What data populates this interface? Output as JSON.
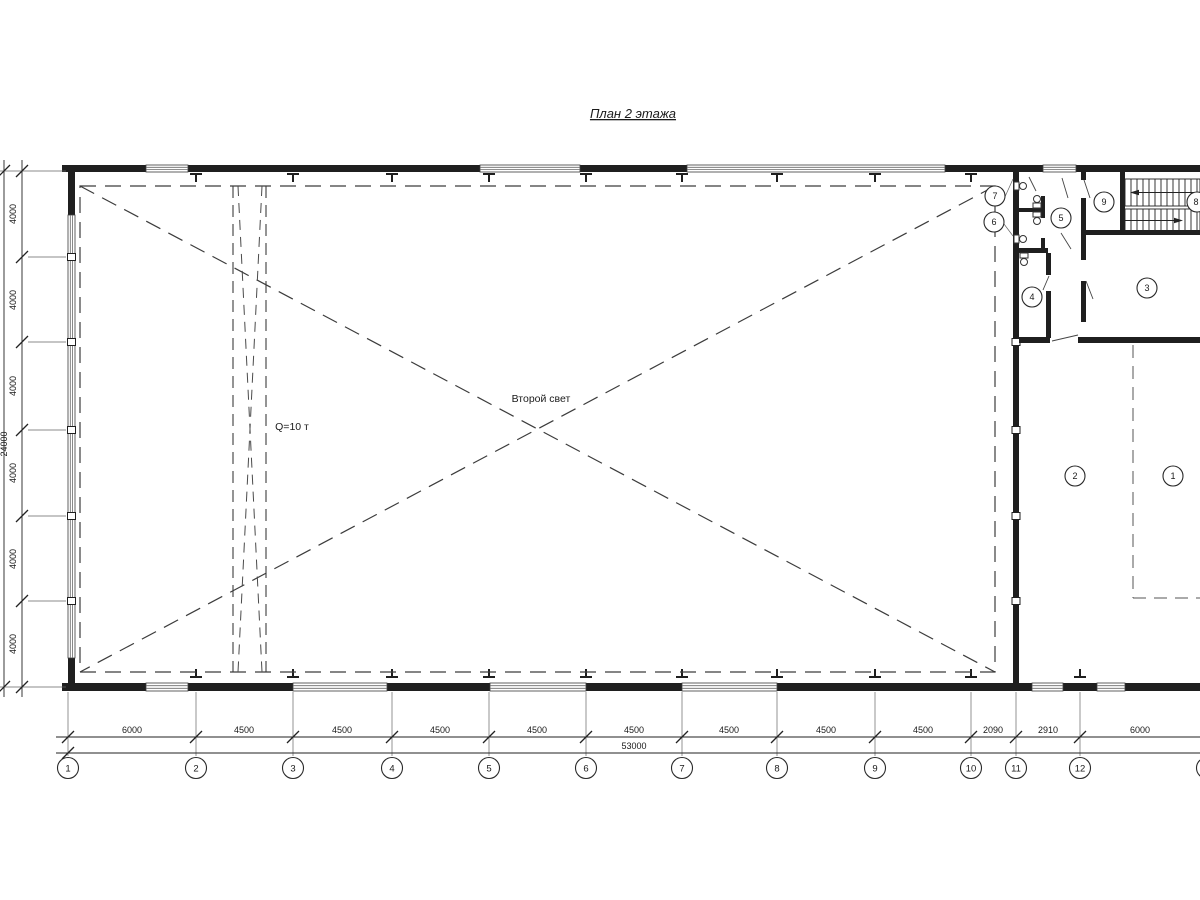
{
  "title": "План 2 этажа",
  "annotations": {
    "second_light": "Второй свет",
    "crane_capacity": "Q=10 т"
  },
  "axes_bottom": {
    "labels": [
      "1",
      "2",
      "3",
      "4",
      "5",
      "6",
      "7",
      "8",
      "9",
      "10",
      "11",
      "12"
    ]
  },
  "dims_bottom": {
    "segments": [
      "6000",
      "4500",
      "4500",
      "4500",
      "4500",
      "4500",
      "4500",
      "4500",
      "4500",
      "2090",
      "2910",
      "6000"
    ],
    "total": "53000"
  },
  "dims_left": {
    "segments": [
      "4000",
      "4000",
      "4000",
      "4000",
      "4000",
      "4000"
    ],
    "total": "24000"
  },
  "rooms": {
    "labels": [
      "1",
      "2",
      "3",
      "4",
      "5",
      "6",
      "7",
      "8",
      "9"
    ]
  }
}
